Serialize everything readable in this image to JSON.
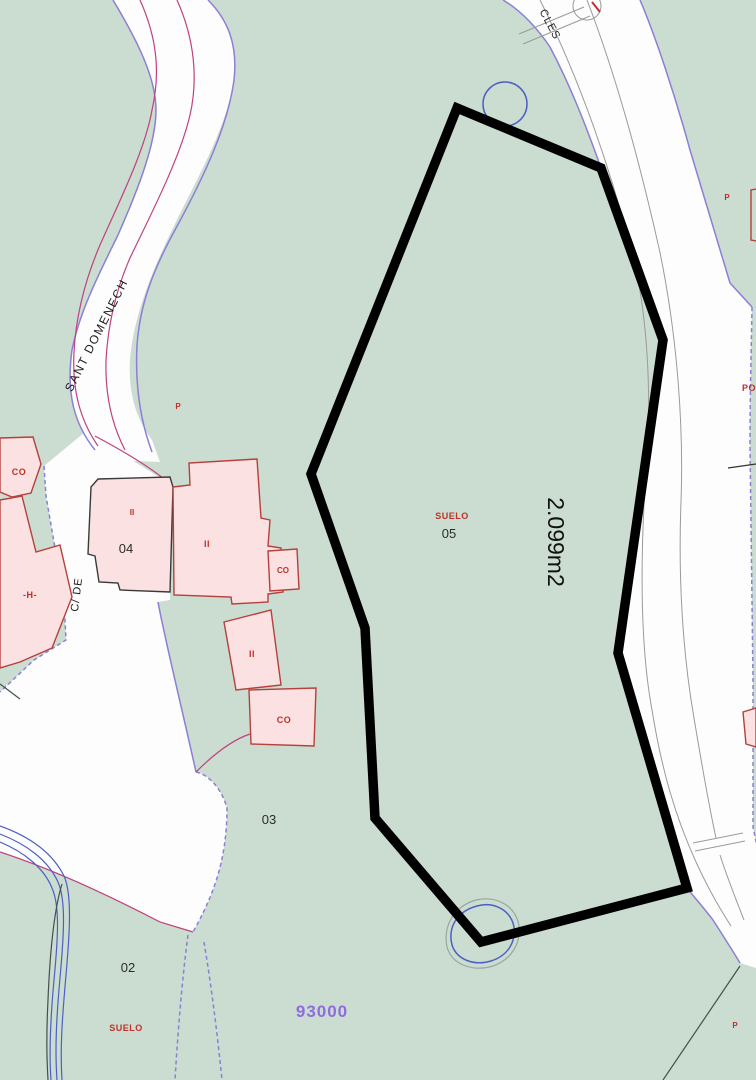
{
  "map": {
    "streets": {
      "sant_domenech": "SANT  DOMENECH",
      "c_de": "C/ DE",
      "top_right_partial": "CLES"
    },
    "parcel_numbers": {
      "p02": "02",
      "p03": "03",
      "p04": "04",
      "p05": "05"
    },
    "area_label": "2.099m2",
    "zone_code": "93000",
    "land_use_label": "SUELO",
    "building_marks": {
      "co": "CO",
      "ii": "II",
      "h": "-H-"
    },
    "point_marks": {
      "p": "P",
      "po_partial": "PO"
    }
  },
  "colors": {
    "bg_green": "#cbdcd1",
    "road_white": "#fdfdfe",
    "edge_purple": "#8b7fd6",
    "line_magenta": "#c0417e",
    "curb_gray": "#9a9a9a",
    "boundary_black": "#000000",
    "building_fill": "#fbe1e1",
    "building_stroke": "#b5403c",
    "water_blue": "#4d5fc2",
    "label_red": "#c03028",
    "zone_purple": "#8f6ce0"
  }
}
